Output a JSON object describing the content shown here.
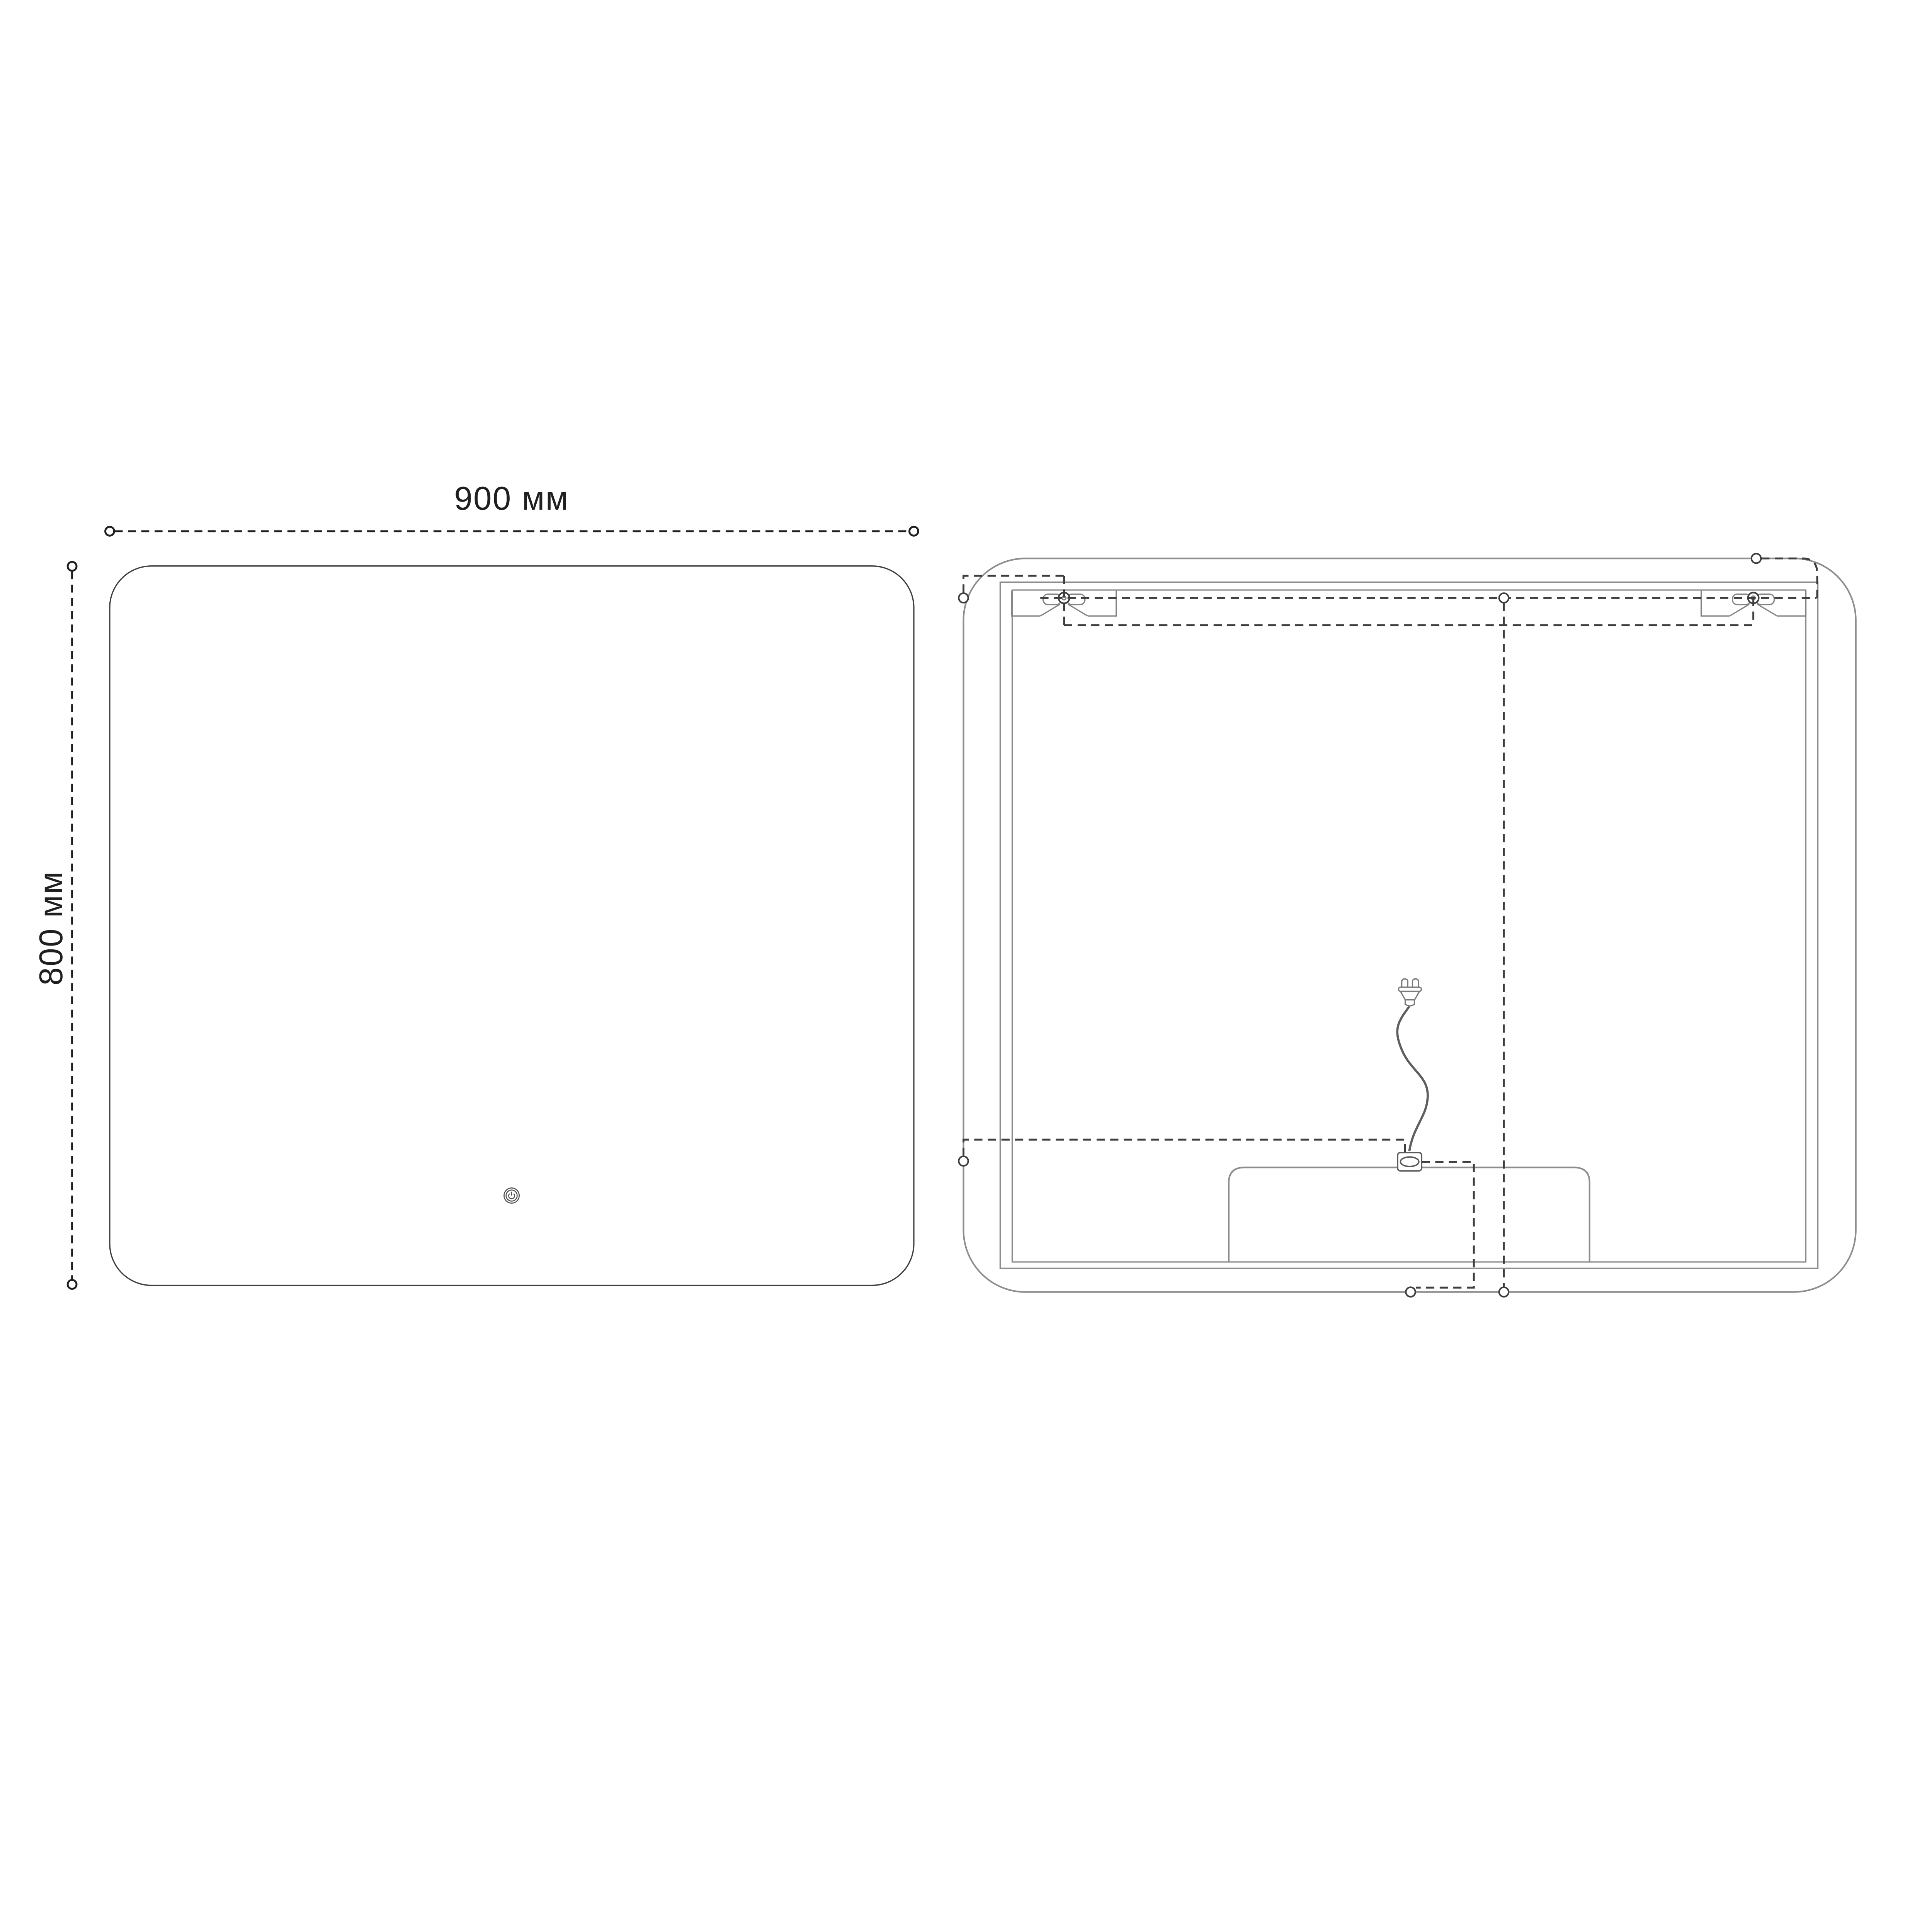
{
  "drawing": {
    "title": "Mirror technical drawing, front and rear views",
    "units": "мм",
    "front_view": {
      "width_value": 900,
      "height_value": 800,
      "width_label": "900 мм",
      "height_label": "800 мм",
      "touch_button": "power-touch-sensor"
    },
    "back_view": {
      "features": [
        "outer-mirror-outline",
        "back-panel-double-border",
        "left-keyhole-mounting-bracket",
        "right-keyhole-mounting-bracket",
        "hidden-mounting-axis-lines",
        "power-cord-with-plug",
        "cable-grommet",
        "driver-box"
      ]
    },
    "colors": {
      "background": "#ffffff",
      "dimension_lines": "#1f1f1f",
      "front_outline": "#3f3f3f",
      "back_outline_grey": "#8d8d8d",
      "hidden_dash": "#3d3d3d"
    }
  }
}
